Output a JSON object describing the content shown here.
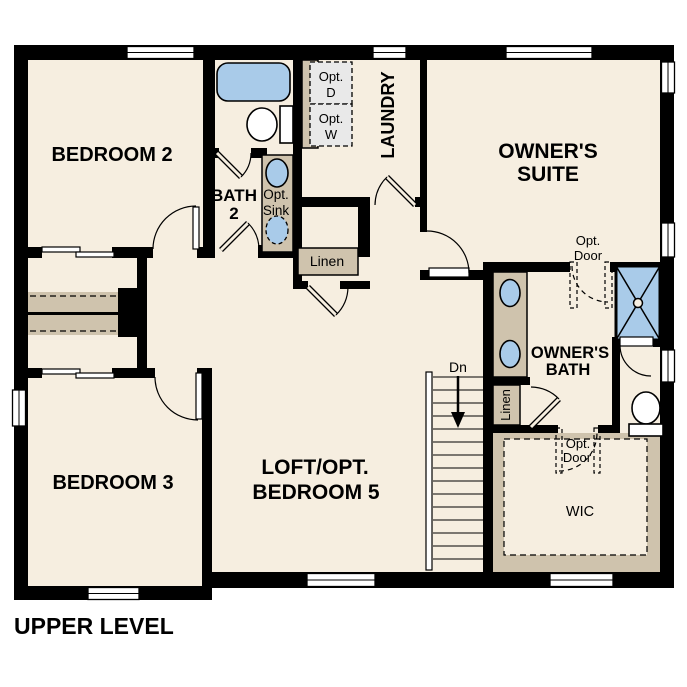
{
  "title": "UPPER LEVEL",
  "rooms": {
    "bedroom2": {
      "label": "BEDROOM 2"
    },
    "bath2": {
      "line1": "BATH",
      "line2": "2"
    },
    "laundry": {
      "label": "LAUNDRY"
    },
    "owners_suite": {
      "line1": "OWNER'S",
      "line2": "SUITE"
    },
    "owners_bath": {
      "line1": "OWNER'S",
      "line2": "BATH"
    },
    "loft": {
      "line1": "LOFT/OPT.",
      "line2": "BEDROOM 5"
    },
    "bedroom3": {
      "label": "BEDROOM 3"
    },
    "wic": {
      "label": "WIC"
    }
  },
  "annotations": {
    "opt_dryer": {
      "line1": "Opt.",
      "line2": "D"
    },
    "opt_washer": {
      "line1": "Opt.",
      "line2": "W"
    },
    "opt_sink": {
      "line1": "Opt.",
      "line2": "Sink"
    },
    "opt_door_suite": {
      "line1": "Opt.",
      "line2": "Door"
    },
    "opt_door_wic": {
      "line1": "Opt.",
      "line2": "Door"
    },
    "linen_hall": {
      "label": "Linen"
    },
    "linen_bath": {
      "label": "Linen"
    },
    "stairs_down": {
      "label": "Dn"
    }
  },
  "colors": {
    "floor": "#f6eee0",
    "wall": "#000000",
    "fixture_blue": "#a9cbe9",
    "cabinet_tan": "#cfc3ad",
    "appliance_gray": "#e9e9e9",
    "window_white": "#ffffff",
    "text": "#000000"
  }
}
